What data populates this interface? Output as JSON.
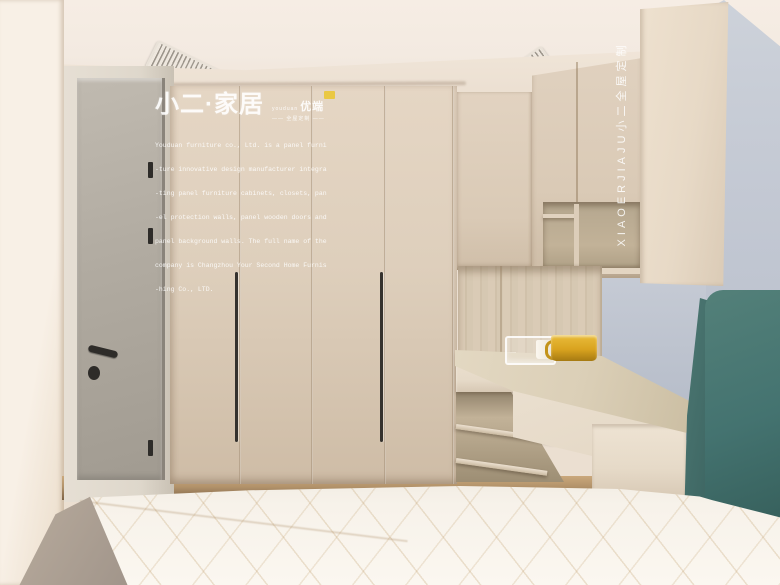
{
  "photo": {
    "watermark": {
      "brand_title": "小二·家居",
      "brand_latin": "youduan",
      "brand_cn": "优端",
      "tagline": "—— 全屋定制 ——",
      "description_lines": [
        "Youduan furniture co., Ltd. is a panel furni",
        "-ture innovative design manufacturer integra",
        "-ting panel furniture cabinets, closets, pan",
        "-el protection walls, panel wooden doors and",
        "panel background walls. The full name of the",
        "company is Changzhou Your Second Home Furnis",
        "-hing Co., LTD."
      ],
      "vertical_text": "XIAOERJIAJU小二全屋定制"
    },
    "palette": {
      "ceiling": "#f3eae1",
      "wall-left": "#f8f0e6",
      "wall-band": "#ebdfd1",
      "wall-blue": "#c6cbd5",
      "wall-blue-dark": "#b3bac7",
      "door": "#b1aba1",
      "door-frame": "#ded7cb",
      "wardrobe": "#decfbc",
      "wardrobe-dark": "#cebca6",
      "cabinet": "#dacab6",
      "side-panel": "#e7d9c6",
      "wood-back": "#d6c8b2",
      "desk-top": "#dbcfb7",
      "desk-front": "#e6dac8",
      "wood-interior": "#c2b298",
      "floor": "#b2926a",
      "mattress": "#f7f2ea",
      "headboard": "#447370",
      "headboard-dark": "#3a615e",
      "amber": "#d9a31f",
      "sticker": "#eac843",
      "hardware": "#2e2c29"
    }
  }
}
